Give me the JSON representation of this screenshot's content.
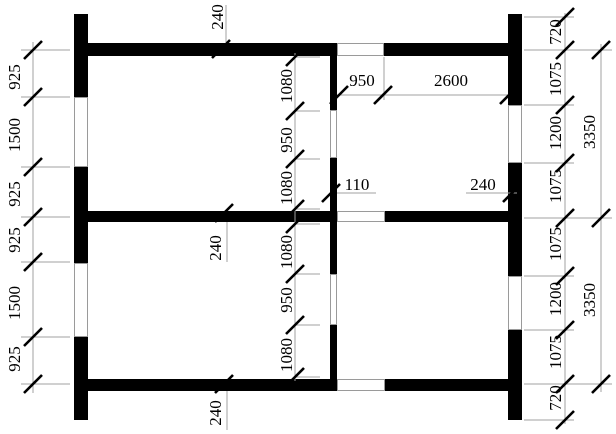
{
  "drawing": {
    "canvas": {
      "w": 616,
      "h": 434,
      "bg": "#ffffff"
    },
    "colors": {
      "wall": "#000000",
      "thin_line": "#a0a0a0",
      "opening_border": "#9a9a9a",
      "tick": "#000000",
      "text": "#000000"
    },
    "font_px": 17,
    "walls": [
      {
        "name": "left-exterior-wall",
        "x": 74,
        "y": 14,
        "w": 14,
        "h": 406
      },
      {
        "name": "right-exterior-wall",
        "x": 508,
        "y": 14,
        "w": 14,
        "h": 406
      },
      {
        "name": "top-exterior-wall",
        "x": 74,
        "y": 43,
        "w": 448,
        "h": 13
      },
      {
        "name": "middle-interior-wall",
        "x": 74,
        "y": 211,
        "w": 448,
        "h": 11
      },
      {
        "name": "bottom-exterior-wall",
        "x": 74,
        "y": 379,
        "w": 448,
        "h": 12
      },
      {
        "name": "center-partition-wall",
        "x": 330,
        "y": 56,
        "w": 7,
        "h": 323
      }
    ],
    "openings": [
      {
        "name": "window-top-wall",
        "x": 337,
        "y": 43,
        "w": 47,
        "h": 13
      },
      {
        "name": "opening-middle-wall",
        "x": 337,
        "y": 211,
        "w": 48,
        "h": 11
      },
      {
        "name": "opening-bottom-wall",
        "x": 337,
        "y": 379,
        "w": 48,
        "h": 12
      },
      {
        "name": "window-left-upper",
        "x": 74,
        "y": 97,
        "w": 14,
        "h": 70
      },
      {
        "name": "window-left-lower",
        "x": 74,
        "y": 263,
        "w": 14,
        "h": 74
      },
      {
        "name": "window-right-upper",
        "x": 508,
        "y": 105,
        "w": 14,
        "h": 58
      },
      {
        "name": "window-right-lower",
        "x": 508,
        "y": 276,
        "w": 14,
        "h": 54
      },
      {
        "name": "door-partition-upper",
        "x": 330,
        "y": 110,
        "w": 7,
        "h": 48
      },
      {
        "name": "door-partition-lower",
        "x": 330,
        "y": 274,
        "w": 7,
        "h": 51
      }
    ],
    "thin_lines": [
      {
        "name": "left-chain-line",
        "x1": 33,
        "y1": 42,
        "x2": 33,
        "y2": 393
      },
      {
        "name": "middle-chain-line",
        "x1": 295,
        "y1": 53,
        "x2": 295,
        "y2": 381
      },
      {
        "name": "right-inner-chain-line",
        "x1": 565,
        "y1": 13,
        "x2": 565,
        "y2": 424
      },
      {
        "name": "right-outer-chain-line",
        "x1": 601,
        "y1": 44,
        "x2": 601,
        "y2": 392
      },
      {
        "name": "room-dim-line",
        "x1": 337,
        "y1": 95,
        "x2": 509,
        "y2": 95
      },
      {
        "name": "window-edge-ext-line",
        "x1": 384,
        "y1": 57,
        "x2": 384,
        "y2": 100
      },
      {
        "name": "dim-110-underline",
        "x1": 337,
        "y1": 193,
        "x2": 376,
        "y2": 193
      },
      {
        "name": "dim-240-underline",
        "x1": 466,
        "y1": 193,
        "x2": 517,
        "y2": 193
      },
      {
        "name": "leader-top-240",
        "x1": 226,
        "y1": 5,
        "x2": 226,
        "y2": 42
      },
      {
        "name": "leader-middle-240",
        "x1": 227,
        "y1": 222,
        "x2": 227,
        "y2": 262
      },
      {
        "name": "leader-bottom-240",
        "x1": 227,
        "y1": 391,
        "x2": 227,
        "y2": 430
      },
      {
        "name": "ext-left-1",
        "x1": 21,
        "y1": 50,
        "x2": 70,
        "y2": 50
      },
      {
        "name": "ext-left-2",
        "x1": 21,
        "y1": 97,
        "x2": 70,
        "y2": 97
      },
      {
        "name": "ext-left-3",
        "x1": 21,
        "y1": 167,
        "x2": 70,
        "y2": 167
      },
      {
        "name": "ext-left-4",
        "x1": 21,
        "y1": 217,
        "x2": 70,
        "y2": 217
      },
      {
        "name": "ext-left-5",
        "x1": 21,
        "y1": 262,
        "x2": 70,
        "y2": 262
      },
      {
        "name": "ext-left-6",
        "x1": 21,
        "y1": 337,
        "x2": 70,
        "y2": 337
      },
      {
        "name": "ext-left-7",
        "x1": 21,
        "y1": 384,
        "x2": 70,
        "y2": 384
      },
      {
        "name": "ext-mid-1",
        "x1": 295,
        "y1": 57,
        "x2": 320,
        "y2": 57
      },
      {
        "name": "ext-mid-2",
        "x1": 295,
        "y1": 111,
        "x2": 320,
        "y2": 111
      },
      {
        "name": "ext-mid-3",
        "x1": 295,
        "y1": 159,
        "x2": 320,
        "y2": 159
      },
      {
        "name": "ext-mid-4",
        "x1": 295,
        "y1": 209,
        "x2": 320,
        "y2": 209
      },
      {
        "name": "ext-mid-5",
        "x1": 295,
        "y1": 224,
        "x2": 320,
        "y2": 224
      },
      {
        "name": "ext-mid-6",
        "x1": 295,
        "y1": 274,
        "x2": 320,
        "y2": 274
      },
      {
        "name": "ext-mid-7",
        "x1": 295,
        "y1": 325,
        "x2": 320,
        "y2": 325
      },
      {
        "name": "ext-mid-8",
        "x1": 295,
        "y1": 377,
        "x2": 320,
        "y2": 377
      },
      {
        "name": "ext-right-1",
        "x1": 524,
        "y1": 17,
        "x2": 574,
        "y2": 17
      },
      {
        "name": "ext-right-2",
        "x1": 524,
        "y1": 50,
        "x2": 612,
        "y2": 50
      },
      {
        "name": "ext-right-3",
        "x1": 524,
        "y1": 105,
        "x2": 574,
        "y2": 105
      },
      {
        "name": "ext-right-4",
        "x1": 524,
        "y1": 163,
        "x2": 574,
        "y2": 163
      },
      {
        "name": "ext-right-5",
        "x1": 524,
        "y1": 218,
        "x2": 612,
        "y2": 218
      },
      {
        "name": "ext-right-6",
        "x1": 524,
        "y1": 276,
        "x2": 574,
        "y2": 276
      },
      {
        "name": "ext-right-7",
        "x1": 524,
        "y1": 330,
        "x2": 574,
        "y2": 330
      },
      {
        "name": "ext-right-8",
        "x1": 524,
        "y1": 384,
        "x2": 612,
        "y2": 384
      },
      {
        "name": "ext-right-9",
        "x1": 524,
        "y1": 420,
        "x2": 574,
        "y2": 420
      }
    ],
    "ticks": [
      {
        "x": 33,
        "y": 50
      },
      {
        "x": 33,
        "y": 97
      },
      {
        "x": 33,
        "y": 167
      },
      {
        "x": 33,
        "y": 217
      },
      {
        "x": 33,
        "y": 262
      },
      {
        "x": 33,
        "y": 337
      },
      {
        "x": 33,
        "y": 384
      },
      {
        "x": 295,
        "y": 57
      },
      {
        "x": 295,
        "y": 111
      },
      {
        "x": 295,
        "y": 159
      },
      {
        "x": 295,
        "y": 209
      },
      {
        "x": 295,
        "y": 224
      },
      {
        "x": 295,
        "y": 274
      },
      {
        "x": 295,
        "y": 325
      },
      {
        "x": 295,
        "y": 377
      },
      {
        "x": 565,
        "y": 17
      },
      {
        "x": 565,
        "y": 50
      },
      {
        "x": 565,
        "y": 105
      },
      {
        "x": 565,
        "y": 163
      },
      {
        "x": 565,
        "y": 218
      },
      {
        "x": 565,
        "y": 276
      },
      {
        "x": 565,
        "y": 330
      },
      {
        "x": 565,
        "y": 384
      },
      {
        "x": 565,
        "y": 420
      },
      {
        "x": 601,
        "y": 50
      },
      {
        "x": 601,
        "y": 218
      },
      {
        "x": 601,
        "y": 384
      },
      {
        "x": 339,
        "y": 95
      },
      {
        "x": 383,
        "y": 95
      },
      {
        "x": 509,
        "y": 95
      },
      {
        "x": 331,
        "y": 193
      },
      {
        "x": 512,
        "y": 193
      },
      {
        "x": 221,
        "y": 49
      },
      {
        "x": 224,
        "y": 213
      },
      {
        "x": 224,
        "y": 384
      }
    ],
    "labels": [
      {
        "name": "dim-240-top-wall",
        "text": "240",
        "x": 217,
        "y": 17,
        "rot": true
      },
      {
        "name": "dim-925-left-1",
        "text": "925",
        "x": 14,
        "y": 77,
        "rot": true
      },
      {
        "name": "dim-1500-left-1",
        "text": "1500",
        "x": 14,
        "y": 135,
        "rot": true
      },
      {
        "name": "dim-925-left-2",
        "text": "925",
        "x": 14,
        "y": 194,
        "rot": true
      },
      {
        "name": "dim-925-left-3",
        "text": "925",
        "x": 14,
        "y": 240,
        "rot": true
      },
      {
        "name": "dim-1500-left-2",
        "text": "1500",
        "x": 14,
        "y": 303,
        "rot": true
      },
      {
        "name": "dim-925-left-4",
        "text": "925",
        "x": 14,
        "y": 359,
        "rot": true
      },
      {
        "name": "dim-1080-mid-1",
        "text": "1080",
        "x": 286,
        "y": 86,
        "rot": true
      },
      {
        "name": "dim-950-mid-1",
        "text": "950",
        "x": 286,
        "y": 140,
        "rot": true
      },
      {
        "name": "dim-1080-mid-2",
        "text": "1080",
        "x": 286,
        "y": 188,
        "rot": true
      },
      {
        "name": "dim-1080-mid-3",
        "text": "1080",
        "x": 286,
        "y": 252,
        "rot": true
      },
      {
        "name": "dim-950-mid-2",
        "text": "950",
        "x": 286,
        "y": 300,
        "rot": true
      },
      {
        "name": "dim-1080-mid-4",
        "text": "1080",
        "x": 286,
        "y": 355,
        "rot": true
      },
      {
        "name": "dim-240-middle-wall",
        "text": "240",
        "x": 215,
        "y": 248,
        "rot": true
      },
      {
        "name": "dim-240-bottom-wall",
        "text": "240",
        "x": 215,
        "y": 413,
        "rot": true
      },
      {
        "name": "dim-950-room",
        "text": "950",
        "x": 362,
        "y": 80,
        "rot": false
      },
      {
        "name": "dim-2600-room",
        "text": "2600",
        "x": 451,
        "y": 80,
        "rot": false
      },
      {
        "name": "dim-110-partition",
        "text": "110",
        "x": 357,
        "y": 184,
        "rot": false
      },
      {
        "name": "dim-240-right-wall",
        "text": "240",
        "x": 483,
        "y": 184,
        "rot": false
      },
      {
        "name": "dim-720-right-1",
        "text": "720",
        "x": 555,
        "y": 32,
        "rot": true
      },
      {
        "name": "dim-1075-right-1",
        "text": "1075",
        "x": 555,
        "y": 79,
        "rot": true
      },
      {
        "name": "dim-1200-right-1",
        "text": "1200",
        "x": 555,
        "y": 133,
        "rot": true
      },
      {
        "name": "dim-1075-right-2",
        "text": "1075",
        "x": 555,
        "y": 186,
        "rot": true
      },
      {
        "name": "dim-1075-right-3",
        "text": "1075",
        "x": 555,
        "y": 244,
        "rot": true
      },
      {
        "name": "dim-1200-right-2",
        "text": "1200",
        "x": 555,
        "y": 299,
        "rot": true
      },
      {
        "name": "dim-1075-right-4",
        "text": "1075",
        "x": 555,
        "y": 352,
        "rot": true
      },
      {
        "name": "dim-720-right-2",
        "text": "720",
        "x": 555,
        "y": 398,
        "rot": true
      },
      {
        "name": "dim-3350-right-top",
        "text": "3350",
        "x": 589,
        "y": 132,
        "rot": true
      },
      {
        "name": "dim-3350-right-bottom",
        "text": "3350",
        "x": 589,
        "y": 300,
        "rot": true
      }
    ]
  }
}
